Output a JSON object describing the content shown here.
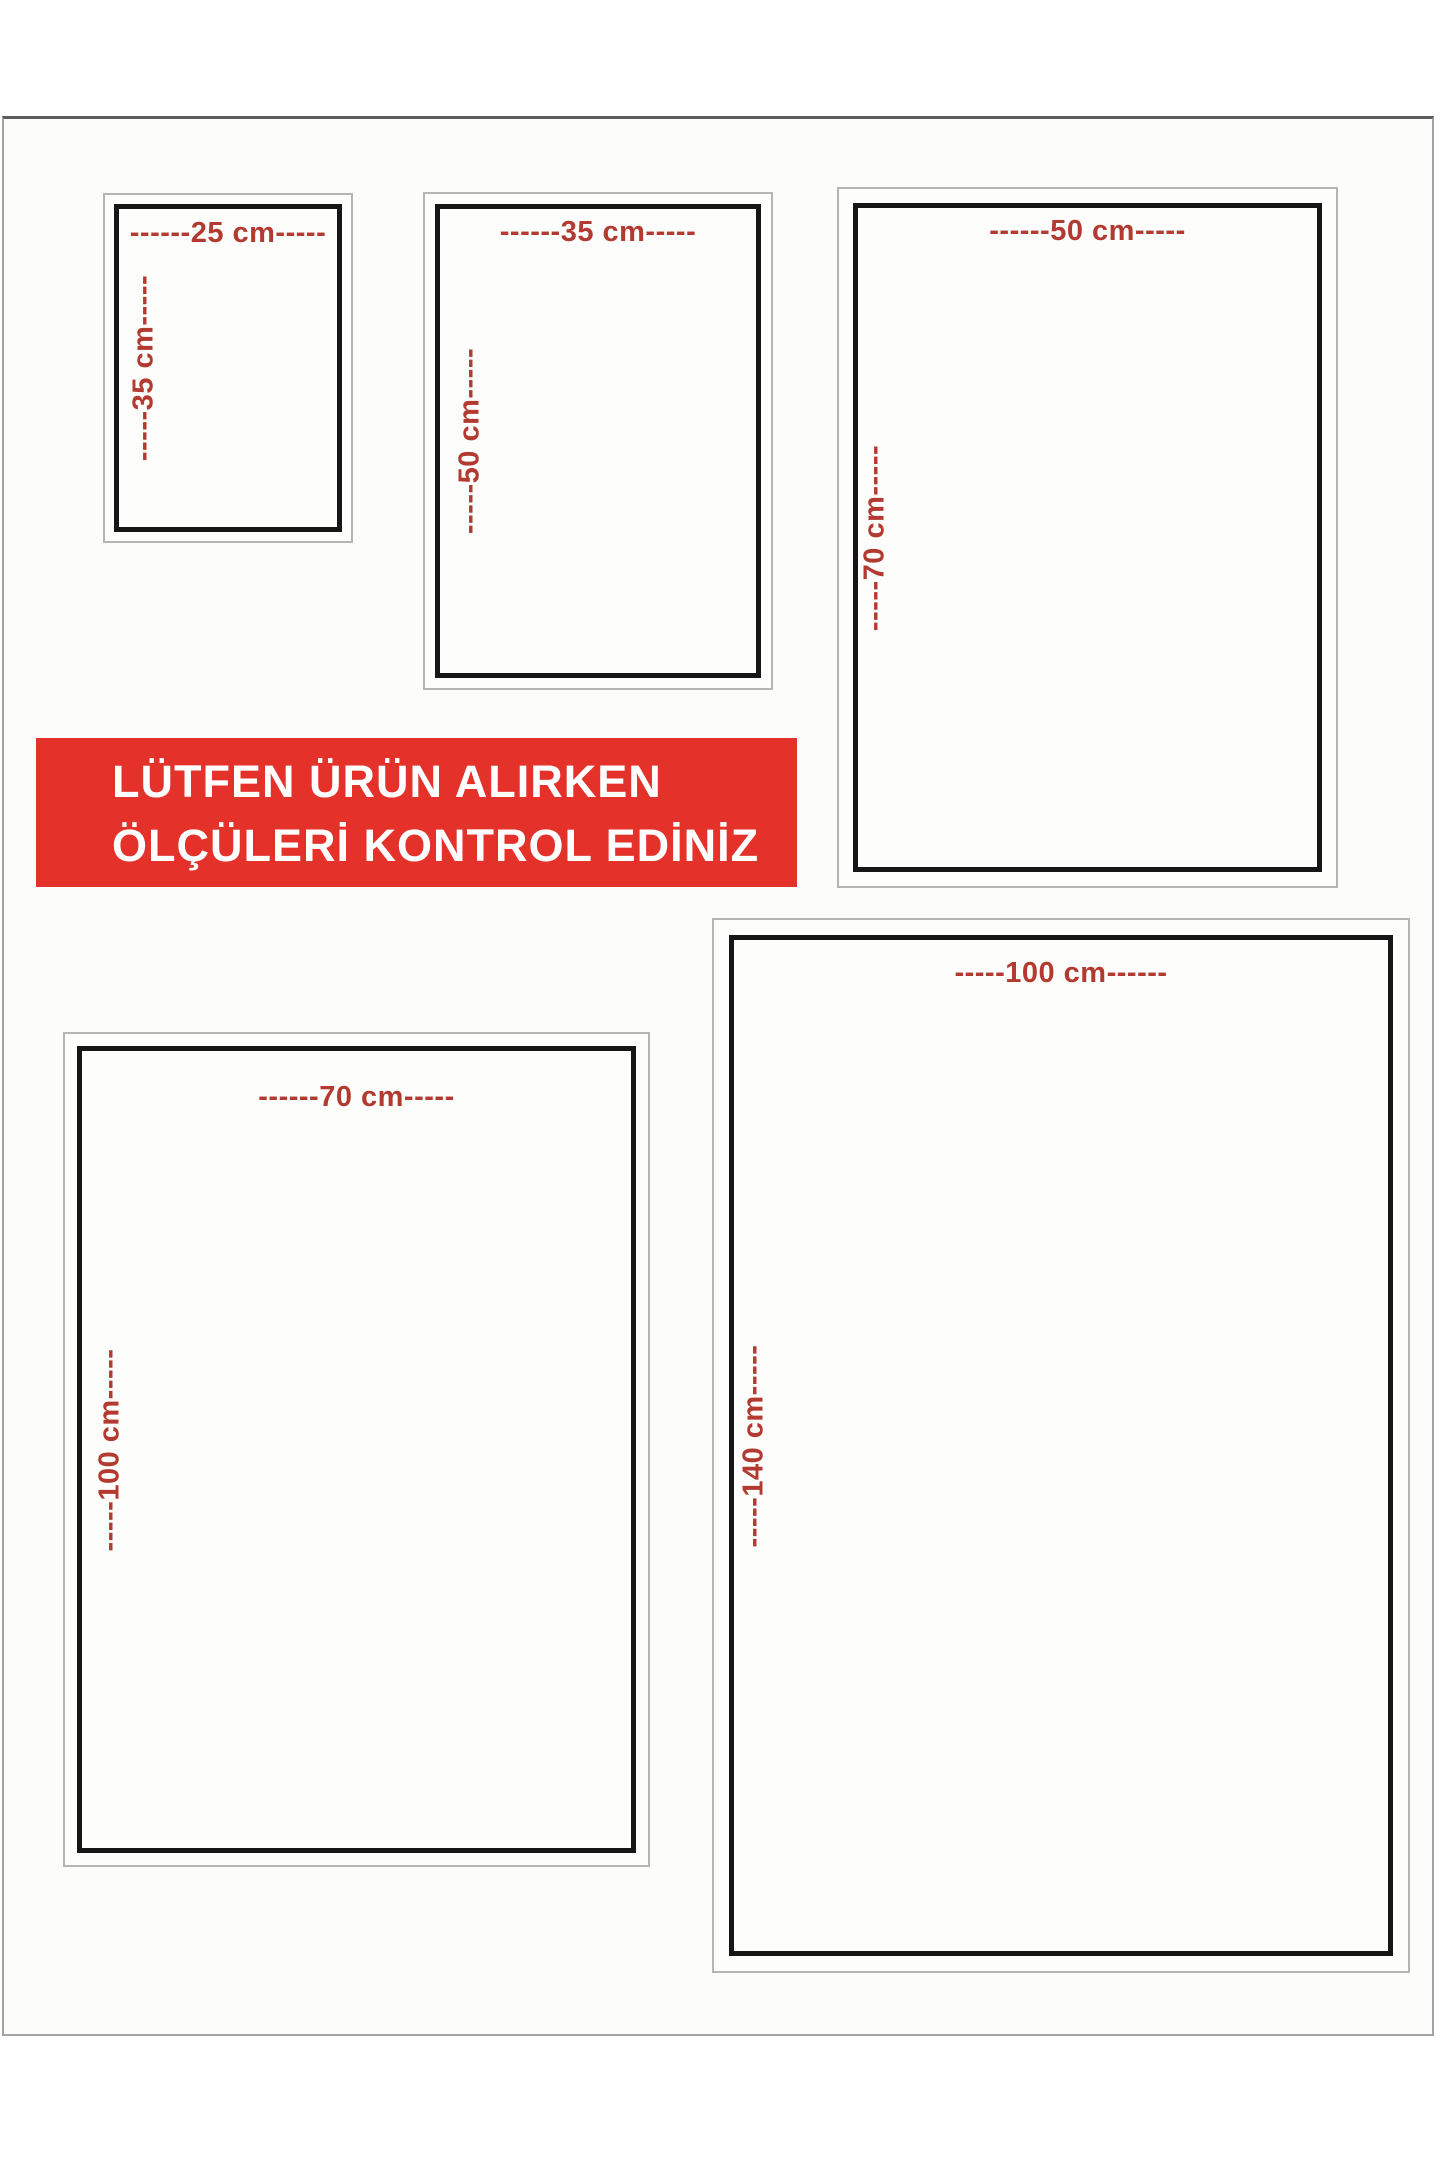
{
  "banner": {
    "line1": "LÜTFEN ÜRÜN ALIRKEN",
    "line2": "ÖLÇÜLERİ KONTROL EDİNİZ"
  },
  "sizes": [
    {
      "name": "25x35",
      "width_cm": 25,
      "height_cm": 35,
      "width_label": "------25 cm-----",
      "height_label": "-----35 cm-----"
    },
    {
      "name": "35x50",
      "width_cm": 35,
      "height_cm": 50,
      "width_label": "------35 cm-----",
      "height_label": "-----50 cm-----"
    },
    {
      "name": "50x70",
      "width_cm": 50,
      "height_cm": 70,
      "width_label": "------50 cm-----",
      "height_label": "-----70 cm-----"
    },
    {
      "name": "70x100",
      "width_cm": 70,
      "height_cm": 100,
      "width_label": "------70 cm-----",
      "height_label": "-----100 cm-----"
    },
    {
      "name": "100x140",
      "width_cm": 100,
      "height_cm": 140,
      "width_label": "-----100 cm------",
      "height_label": "-----140 cm-----"
    }
  ],
  "colors": {
    "label_red": "#b23a30",
    "banner_bg": "#e4322b",
    "banner_text": "#ffffff",
    "frame_black": "#161616",
    "frame_gray": "#b5b5b5",
    "paper_edge": "#a3a3a3",
    "paper_edge_top": "#5c5c5c",
    "paper_bg": "#fcfcfb"
  }
}
